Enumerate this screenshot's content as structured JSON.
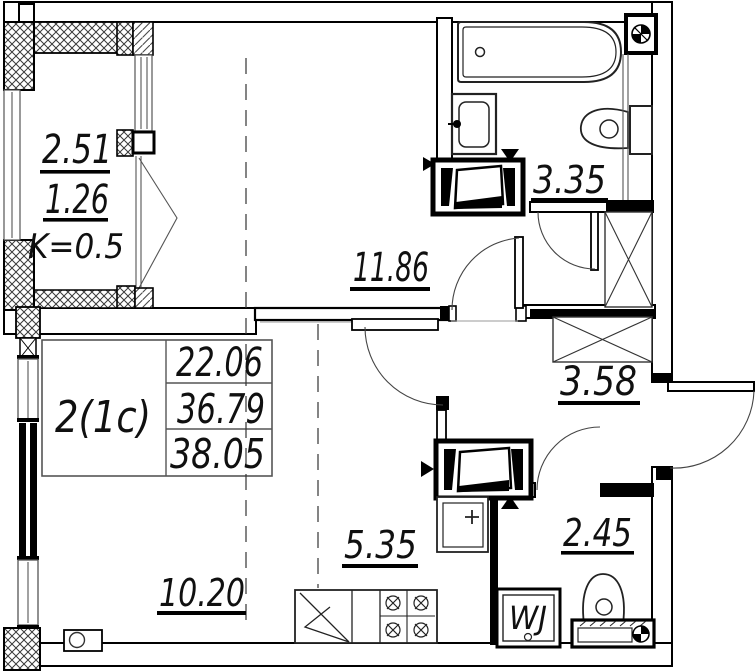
{
  "balcony": {
    "area_top": "2.51",
    "area_bottom": "1.26",
    "coefficient": "K=0.5"
  },
  "rooms": {
    "living": {
      "area": "11.86"
    },
    "bathroom": {
      "area": "3.35"
    },
    "hallway": {
      "area": "3.58"
    },
    "bedroom": {
      "area": "10.20"
    },
    "kitchen": {
      "area": "5.35"
    },
    "wc": {
      "area": "2.45"
    }
  },
  "info_table": {
    "apartment_type": "2(1c)",
    "rows": [
      "22.06",
      "36.79",
      "38.05"
    ]
  },
  "labels": {
    "washer": "WJ"
  },
  "colors": {
    "line": "#000000",
    "hatch": "#4a4a4a",
    "background": "#ffffff"
  }
}
